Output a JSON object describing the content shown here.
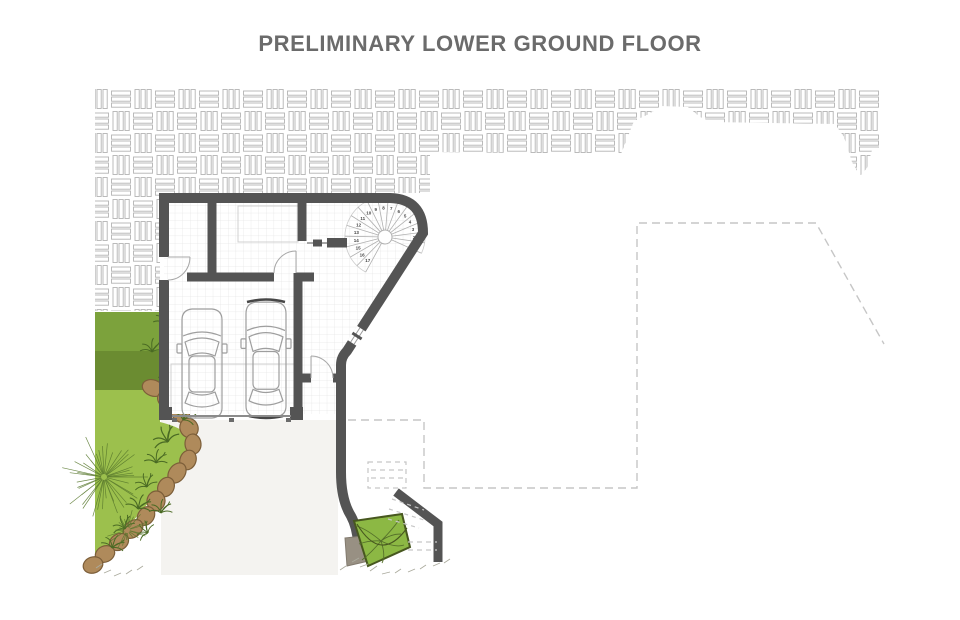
{
  "title": "PRELIMINARY LOWER GROUND FLOOR",
  "stair": {
    "steps": [
      "1",
      "2",
      "3",
      "4",
      "5",
      "6",
      "7",
      "8",
      "9",
      "10",
      "11",
      "12",
      "13",
      "14",
      "15",
      "16",
      "17"
    ]
  },
  "palette": {
    "wall": "#545454",
    "paving_line": "#b4b4b4",
    "tile_line": "#e5e5e5",
    "dashed_line": "#c6c6c6",
    "green_band_top": "#7CA23C",
    "green_band_mid": "#6B8C31",
    "green_lawn": "#9CC04D",
    "shrub_bed": "#8CB844",
    "stone_fill": "#AF8A5B",
    "stone_edge": "#7C5E39",
    "plant_stroke": "#4A6A24",
    "title_color": "#6b6b6b",
    "car_stroke": "#9e9e9e",
    "driveway": "#F4F3F0"
  }
}
